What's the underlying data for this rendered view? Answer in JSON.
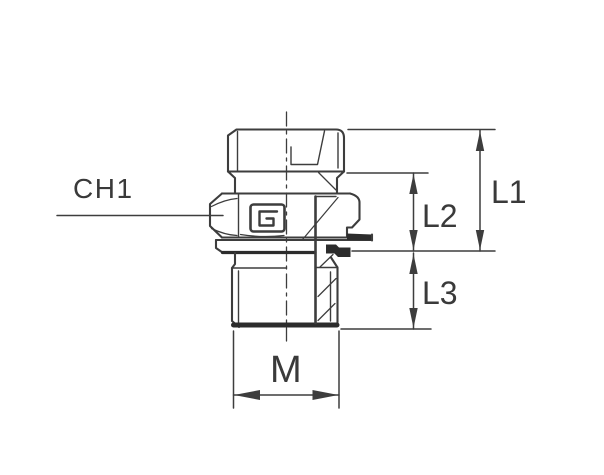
{
  "colors": {
    "line": "#3d3d3d",
    "text": "#3a3a3a",
    "dark": "#2c2c2c",
    "bg": "#ffffff"
  },
  "drawing": {
    "kind": "technical line drawing, half-section",
    "subject": "male stud fitting with hex nut and seal",
    "labels": {
      "ch1": "CH1",
      "l1": "L1",
      "l2": "L2",
      "l3": "L3",
      "m": "M"
    }
  }
}
